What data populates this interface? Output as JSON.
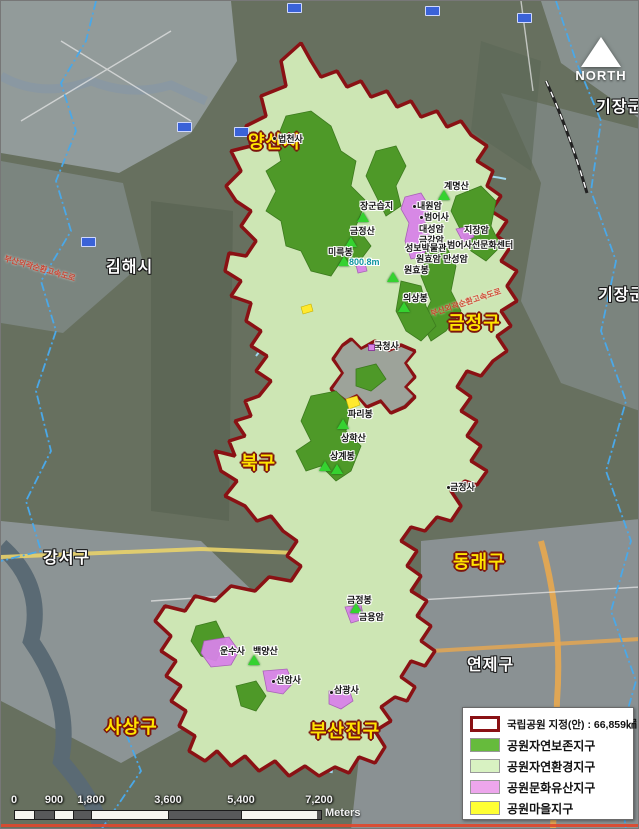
{
  "map": {
    "north_label": "NORTH",
    "districts": [
      {
        "text": "양산시",
        "style": "yellow"
      },
      {
        "text": "김해시",
        "style": "white"
      },
      {
        "text": "기장군",
        "style": "white"
      },
      {
        "text": "기장군",
        "style": "white"
      },
      {
        "text": "금정구",
        "style": "yellow"
      },
      {
        "text": "북구",
        "style": "yellow"
      },
      {
        "text": "강서구",
        "style": "white"
      },
      {
        "text": "동래구",
        "style": "yellow"
      },
      {
        "text": "연제구",
        "style": "white"
      },
      {
        "text": "사상구",
        "style": "yellow"
      },
      {
        "text": "부산진구",
        "style": "yellow"
      }
    ],
    "places": [
      {
        "text": "법천사",
        "marker": "temple-dot"
      },
      {
        "text": "계명산",
        "marker": "peak-triangle"
      },
      {
        "text": "장군습지",
        "marker": "peak-triangle"
      },
      {
        "text": "내원암",
        "marker": "temple-dot"
      },
      {
        "text": "범어사",
        "marker": "temple-dot"
      },
      {
        "text": "금정산",
        "marker": "peak-triangle"
      },
      {
        "text": "대성암",
        "marker": "none"
      },
      {
        "text": "금강암",
        "marker": "none"
      },
      {
        "text": "지장암",
        "marker": "none"
      },
      {
        "text": "성보박물관",
        "marker": "none"
      },
      {
        "text": "범어사선문화센터",
        "marker": "none"
      },
      {
        "text": "원효암",
        "marker": "none"
      },
      {
        "text": "만성암",
        "marker": "none"
      },
      {
        "text": "미륵봉",
        "marker": "peak-triangle"
      },
      {
        "text": "800.8m",
        "marker": "none"
      },
      {
        "text": "원효봉",
        "marker": "peak-triangle"
      },
      {
        "text": "의상봉",
        "marker": "peak-triangle"
      },
      {
        "text": "국청사",
        "marker": "heritage-dot"
      },
      {
        "text": "파리봉",
        "marker": "peak-triangle"
      },
      {
        "text": "상학산",
        "marker": "none"
      },
      {
        "text": "상계봉",
        "marker": "peak-triangle"
      },
      {
        "text": "금정사",
        "marker": "temple-dot"
      },
      {
        "text": "금정봉",
        "marker": "peak-triangle"
      },
      {
        "text": "금용암",
        "marker": "none"
      },
      {
        "text": "운수사",
        "marker": "none"
      },
      {
        "text": "백양산",
        "marker": "peak-triangle"
      },
      {
        "text": "선암사",
        "marker": "temple-dot"
      },
      {
        "text": "삼광사",
        "marker": "temple-dot"
      }
    ],
    "road_labels": [
      {
        "text": "부산외곽순환고속도로"
      },
      {
        "text": "부산외곽순환고속도로"
      }
    ]
  },
  "legend": {
    "boundary_label": "국립공원 지정(안) : 66,859㎢",
    "boundary_color": "#8a1114",
    "items": [
      {
        "label": "공원자연보존지구",
        "color": "#66bb3c"
      },
      {
        "label": "공원자연환경지구",
        "color": "#d8f2c2"
      },
      {
        "label": "공원문화유산지구",
        "color": "#eda6ec"
      },
      {
        "label": "공원마을지구",
        "color": "#ffff33"
      }
    ]
  },
  "scalebar": {
    "ticks": [
      "0",
      "900",
      "1,800",
      "3,600",
      "5,400",
      "7,200"
    ],
    "unit": "Meters"
  },
  "colors": {
    "park_boundary": "#8a1114",
    "preservation_zone": "#4e9928",
    "environment_zone": "#cde6b4",
    "heritage_zone": "#d883e8",
    "village_zone": "#ffe92e",
    "district_label_primary": "#ffe400",
    "district_label_secondary": "#ffffff"
  }
}
